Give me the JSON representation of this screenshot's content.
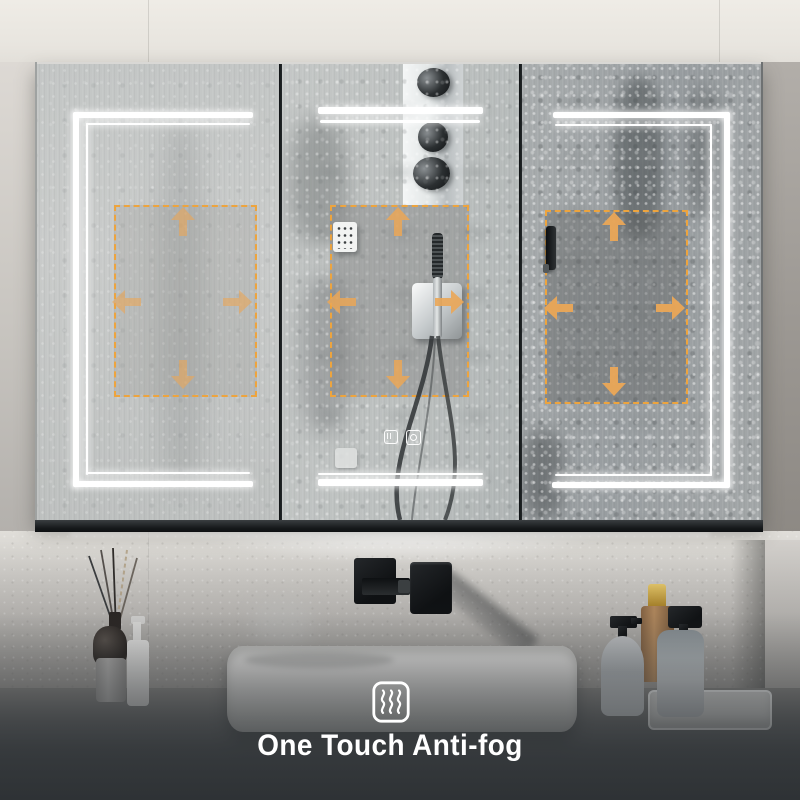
{
  "caption": {
    "text": "One Touch Anti-fog",
    "icon": "anti-fog-steam-icon"
  },
  "colors": {
    "led_strip": "#ffffff",
    "defog_dashed_outline": "#eda43e",
    "defog_arrow": "#eba757",
    "caption_text": "#ffffff",
    "wall_upper": "#eae7e1",
    "bottom_shade": "#4c5053"
  },
  "cabinet": {
    "panel_count": 3,
    "panels": [
      {
        "id": "left",
        "led_layout": "top-left-bottom",
        "defog_zone": true,
        "fog_level": "light"
      },
      {
        "id": "middle",
        "led_layout": "top-bottom",
        "defog_zone": true,
        "fog_level": "medium",
        "touch_controls": [
          {
            "icon": "anti-fog-touch-button-icon"
          },
          {
            "icon": "light-touch-button-icon"
          }
        ]
      },
      {
        "id": "right",
        "led_layout": "top-right-bottom",
        "defog_zone": true,
        "fog_level": "heavy"
      }
    ]
  },
  "scene": {
    "reflections": [
      "shower-panel",
      "shower-knobs",
      "hand-shower",
      "shower-hoses",
      "door-handle"
    ],
    "counter_items": [
      "reed-diffuser",
      "lotion-pump-bottle",
      "vessel-sink",
      "wall-mounted-black-faucet",
      "soap-dispenser",
      "amber-spray-bottle",
      "soap-dispenser",
      "tray"
    ]
  }
}
